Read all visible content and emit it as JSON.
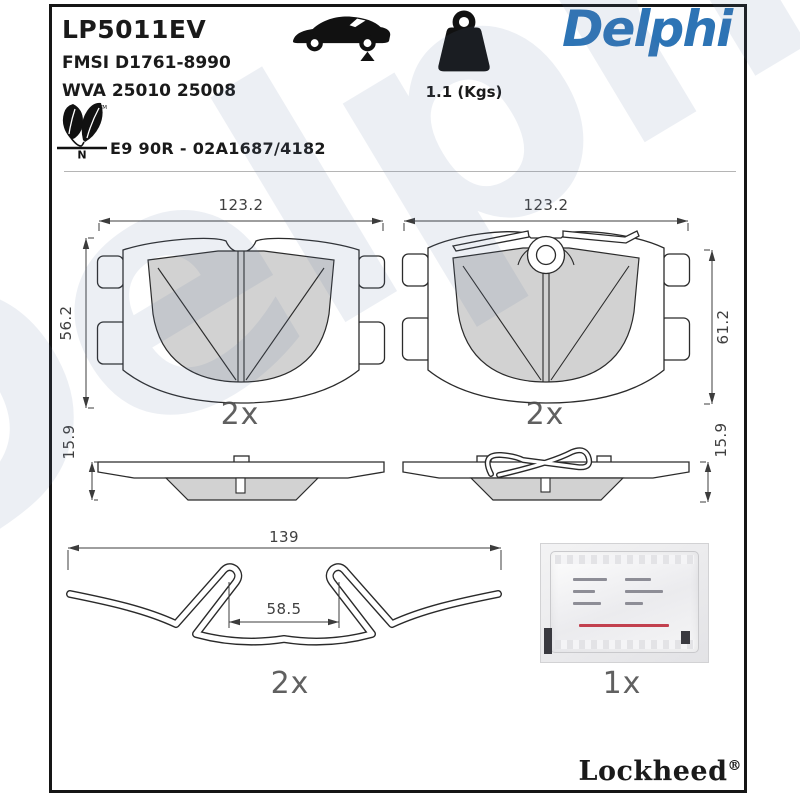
{
  "header": {
    "part_number": "LP5011EV",
    "fmsi": "FMSI D1761-8990",
    "wva": "WVA 25010 25008",
    "weight": "1.1 (Kgs)",
    "brand": "Delphi",
    "eco_letter": "N",
    "eco_tm": "TM",
    "approval": "E9 90R - 02A1687/4182",
    "icons": {
      "vehicle": "car-side-silhouette-rear-axle-marker",
      "weight": "kettlebell-weight",
      "eco": "leaf-pair"
    }
  },
  "drawings": {
    "pad_front_left": {
      "width": "123.2",
      "height": "56.2",
      "qty": "2x"
    },
    "pad_front_right": {
      "width": "123.2",
      "height": "61.2",
      "qty": "2x"
    },
    "pad_side_left": {
      "thickness": "15.9"
    },
    "pad_side_right": {
      "thickness": "15.9"
    },
    "clip": {
      "width": "139",
      "inner_width": "58.5",
      "qty": "2x"
    },
    "sachet": {
      "qty": "1x"
    }
  },
  "footer": {
    "logo": "Lockheed",
    "registered": "®"
  },
  "watermark": "Delphi",
  "colors": {
    "brand_blue": "#2d74b5",
    "friction_gray": "#d2d2d2",
    "line_black": "#161616"
  }
}
